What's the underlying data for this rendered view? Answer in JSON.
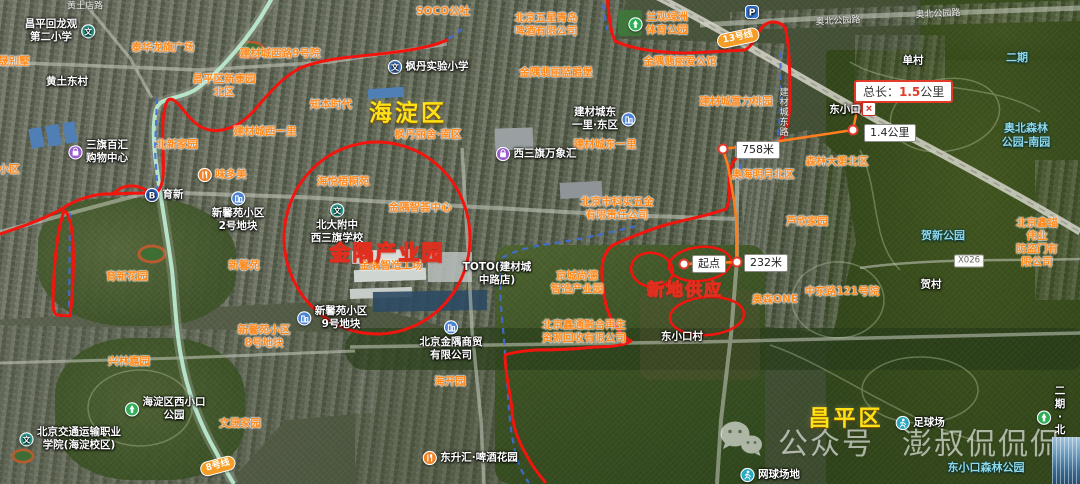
{
  "colors": {
    "route_annotation": "#f2150e",
    "measure_line": "#ff7e1e",
    "annotation_text": "#ffd700",
    "district_text": "#ffe115",
    "poi_orange": "#ff8a1e",
    "poi_cyan": "#8fd8ea"
  },
  "watermark": {
    "platform": "公众号",
    "account": "澎叔侃侃侃"
  },
  "measure": {
    "total_prefix": "总长：",
    "total_value": "1.5",
    "total_unit": "公里",
    "close_glyph": "×",
    "waypoints": [
      {
        "x": 684,
        "y": 264
      },
      {
        "x": 737,
        "y": 262
      },
      {
        "x": 723,
        "y": 149
      },
      {
        "x": 853,
        "y": 130
      }
    ],
    "endpoint": {
      "x": 857,
      "y": 108
    }
  },
  "labels": [
    {
      "t": "SOCO公社",
      "x": 443,
      "y": 12,
      "k": "o"
    },
    {
      "t": "泰华龙旗广场",
      "x": 163,
      "y": 48,
      "k": "o"
    },
    {
      "t": "建材城西路9号院",
      "x": 280,
      "y": 54,
      "k": "o"
    },
    {
      "t": "晟别墅",
      "x": 14,
      "y": 62,
      "k": "o"
    },
    {
      "t": "昌平区新康园\n北区",
      "x": 224,
      "y": 86,
      "k": "o"
    },
    {
      "t": "知本时代",
      "x": 331,
      "y": 105,
      "k": "o"
    },
    {
      "t": "建材城西一里",
      "x": 265,
      "y": 132,
      "k": "o"
    },
    {
      "t": "北新家园",
      "x": 177,
      "y": 145,
      "k": "o"
    },
    {
      "t": "小区",
      "x": 9,
      "y": 170,
      "k": "o"
    },
    {
      "t": "味多美",
      "x": 222,
      "y": 175,
      "k": "o",
      "i": "bakery",
      "lp": "right"
    },
    {
      "t": "育新花园",
      "x": 127,
      "y": 277,
      "k": "o"
    },
    {
      "t": "新馨苑",
      "x": 244,
      "y": 266,
      "k": "o"
    },
    {
      "t": "海悦梧桐苑",
      "x": 343,
      "y": 182,
      "k": "o"
    },
    {
      "t": "金隅智荟中心",
      "x": 420,
      "y": 208,
      "k": "o"
    },
    {
      "t": "金隅智造工场",
      "x": 391,
      "y": 266,
      "k": "o"
    },
    {
      "t": "枫丹丽舍·南区",
      "x": 428,
      "y": 135,
      "k": "o"
    },
    {
      "t": "金隅翡丽蓝爵堡",
      "x": 556,
      "y": 73,
      "k": "o"
    },
    {
      "t": "北京五星青岛\n啤酒有限公司",
      "x": 546,
      "y": 25,
      "k": "o"
    },
    {
      "t": "兰观绿洲\n体育公园",
      "x": 658,
      "y": 24,
      "k": "o",
      "i": "park",
      "lp": "right"
    },
    {
      "t": "金隅翡丽爱公馆",
      "x": 680,
      "y": 62,
      "k": "o"
    },
    {
      "t": "建材城富力桃园",
      "x": 736,
      "y": 102,
      "k": "o"
    },
    {
      "t": "建材城东一里",
      "x": 605,
      "y": 145,
      "k": "o"
    },
    {
      "t": "奥海明月北区",
      "x": 763,
      "y": 175,
      "k": "o"
    },
    {
      "t": "森林大第北区",
      "x": 837,
      "y": 162,
      "k": "o"
    },
    {
      "t": "芦欣家园",
      "x": 807,
      "y": 222,
      "k": "o"
    },
    {
      "t": "中东路121号院",
      "x": 842,
      "y": 292,
      "k": "o"
    },
    {
      "t": "北京鑫锚伟业\n防盗门有限公司",
      "x": 1037,
      "y": 243,
      "k": "o"
    },
    {
      "t": "奥森ONE",
      "x": 775,
      "y": 300,
      "k": "o"
    },
    {
      "t": "北京市科实五金\n有限责任公司",
      "x": 617,
      "y": 209,
      "k": "o"
    },
    {
      "t": "京城尚德\n智造产业园",
      "x": 577,
      "y": 283,
      "k": "o"
    },
    {
      "t": "北京鑫通融合再生\n资源回收有限公司",
      "x": 584,
      "y": 332,
      "k": "o"
    },
    {
      "t": "新馨苑小区\n8号地块",
      "x": 264,
      "y": 337,
      "k": "o"
    },
    {
      "t": "兴林嘉园",
      "x": 129,
      "y": 362,
      "k": "o"
    },
    {
      "t": "文晟家园",
      "x": 240,
      "y": 424,
      "k": "o"
    },
    {
      "t": "海开园",
      "x": 450,
      "y": 382,
      "k": "o"
    },
    {
      "t": "昌平回龙观\n第二小学",
      "x": 60,
      "y": 31,
      "k": "w",
      "i": "school",
      "lp": "left"
    },
    {
      "t": "黄土东村",
      "x": 67,
      "y": 82,
      "k": "w"
    },
    {
      "t": "枫丹实验小学",
      "x": 428,
      "y": 67,
      "k": "w",
      "i": "school2",
      "lp": "right"
    },
    {
      "t": "建材城东\n一里·东区",
      "x": 604,
      "y": 119,
      "k": "w",
      "i": "bld",
      "lp": "left"
    },
    {
      "t": "西三旗万象汇",
      "x": 536,
      "y": 154,
      "k": "w",
      "i": "shop",
      "lp": "right"
    },
    {
      "t": "单村",
      "x": 913,
      "y": 61,
      "k": "w"
    },
    {
      "t": "北大附中\n西三旗学校",
      "x": 337,
      "y": 224,
      "k": "w",
      "i": "school",
      "lp": "below"
    },
    {
      "t": "TOTO(建材城\n中路店)",
      "x": 497,
      "y": 274,
      "k": "w"
    },
    {
      "t": "新馨苑小区\n2号地块",
      "x": 238,
      "y": 212,
      "k": "w",
      "i": "bld",
      "lp": "below"
    },
    {
      "t": "新馨苑小区\n9号地块",
      "x": 332,
      "y": 318,
      "k": "w",
      "i": "bld",
      "lp": "right"
    },
    {
      "t": "育新",
      "x": 164,
      "y": 195,
      "k": "w",
      "i": "subway",
      "lp": "right"
    },
    {
      "t": "三旗百汇\n购物中心",
      "x": 98,
      "y": 152,
      "k": "w",
      "i": "shop",
      "lp": "right"
    },
    {
      "t": "北京金隅商贸\n有限公司",
      "x": 451,
      "y": 341,
      "k": "w",
      "i": "bld",
      "lp": "below"
    },
    {
      "t": "海淀区西小口\n公园",
      "x": 165,
      "y": 409,
      "k": "w",
      "i": "park",
      "lp": "right"
    },
    {
      "t": "北京交通运输职业\n学院(海淀校区)",
      "x": 70,
      "y": 439,
      "k": "w",
      "i": "school",
      "lp": "right"
    },
    {
      "t": "东升汇·啤酒花园",
      "x": 470,
      "y": 458,
      "k": "w",
      "i": "bakery",
      "lp": "right"
    },
    {
      "t": "东小口村",
      "x": 682,
      "y": 337,
      "k": "w"
    },
    {
      "t": "贺村",
      "x": 931,
      "y": 285,
      "k": "w"
    },
    {
      "t": "足球场",
      "x": 920,
      "y": 423,
      "k": "w",
      "i": "sport",
      "lp": "right"
    },
    {
      "t": "网球场地",
      "x": 770,
      "y": 475,
      "k": "w",
      "i": "sport",
      "lp": "right"
    },
    {
      "t": "二期·北区",
      "x": 1051,
      "y": 418,
      "k": "w",
      "i": "park",
      "lp": "right"
    },
    {
      "t": "",
      "x": 752,
      "y": 12,
      "k": "w",
      "i": "pk",
      "lp": "right",
      "n": "parking-poi"
    },
    {
      "t": "二期",
      "x": 1017,
      "y": 58,
      "k": "c"
    },
    {
      "t": "奥北森林\n公园-南园",
      "x": 1026,
      "y": 135,
      "k": "c"
    },
    {
      "t": "贺新公园",
      "x": 943,
      "y": 236,
      "k": "c"
    },
    {
      "t": "东小口森林公园",
      "x": 986,
      "y": 468,
      "k": "c"
    },
    {
      "t": "奥北公园路",
      "x": 838,
      "y": 22,
      "k": "r",
      "rot": -3
    },
    {
      "t": "奥北公园路",
      "x": 938,
      "y": 15,
      "k": "r",
      "rot": -3
    },
    {
      "t": "黄土店路",
      "x": 85,
      "y": 7,
      "k": "r"
    },
    {
      "t": "建材城东路",
      "x": 782,
      "y": 112,
      "k": "rv"
    },
    {
      "t": "X026",
      "x": 969,
      "y": 261,
      "k": "rb"
    },
    {
      "t": "13号线",
      "x": 738,
      "y": 38,
      "k": "badge",
      "rot": -12,
      "n": "subway-line-13-badge"
    },
    {
      "t": "8号线",
      "x": 218,
      "y": 466,
      "k": "badge",
      "rot": -15,
      "n": "subway-line-8-badge"
    },
    {
      "t": "海淀区",
      "x": 408,
      "y": 114,
      "k": "by",
      "fs": 23,
      "n": "district-label-haidian"
    },
    {
      "t": "昌平区",
      "x": 846,
      "y": 419,
      "k": "by",
      "fs": 22,
      "n": "district-label-changping"
    },
    {
      "t": "金隅产业园",
      "x": 387,
      "y": 253,
      "k": "byr",
      "fs": 21,
      "n": "annotation-jinyu-industrial-park"
    },
    {
      "t": "新地供应",
      "x": 685,
      "y": 291,
      "k": "byr",
      "fs": 17,
      "n": "annotation-new-land-supply"
    },
    {
      "t": "东小口",
      "x": 845,
      "y": 110,
      "k": "w",
      "n": "station-label-dongxiaokou"
    },
    {
      "t": "起点",
      "x": 692,
      "y": 264,
      "k": "dist",
      "n": "measure-start-label"
    },
    {
      "t": "232米",
      "x": 744,
      "y": 263,
      "k": "dist",
      "n": "measure-distance-label"
    },
    {
      "t": "758米",
      "x": 736,
      "y": 150,
      "k": "dist",
      "n": "measure-distance-label"
    },
    {
      "t": "1.4公里",
      "x": 864,
      "y": 133,
      "k": "dist",
      "n": "measure-distance-label"
    }
  ]
}
